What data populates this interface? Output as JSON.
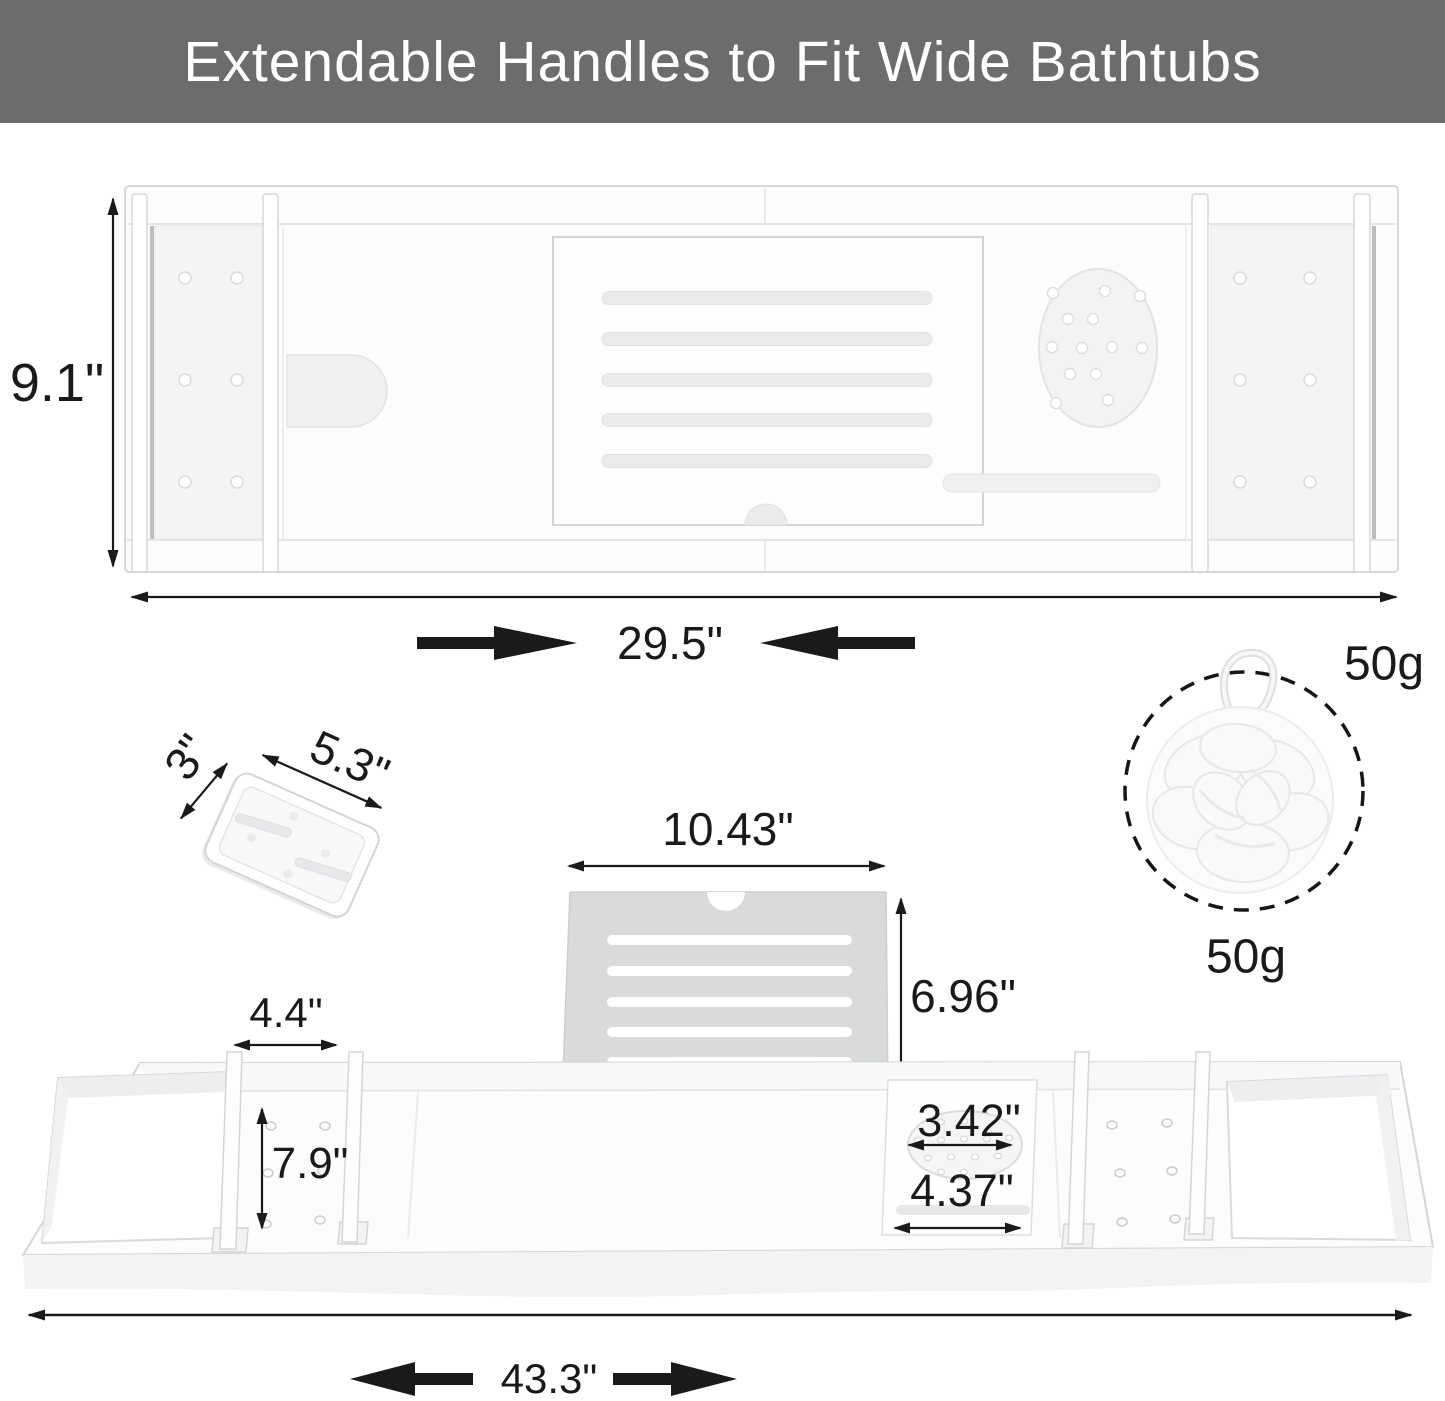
{
  "header": {
    "title": "Extendable Handles to Fit Wide Bathtubs",
    "bg_color": "#6a6c6d",
    "text_color": "#ffffff"
  },
  "colors": {
    "dimension_ink": "#1a1a1a",
    "product_outline": "#d5d7d9",
    "stand_fill": "#d8dadb",
    "background": "#ffffff"
  },
  "top_view": {
    "depth_label": "9.1\"",
    "retracted_width_label": "29.5\""
  },
  "soap_dish": {
    "depth_label": "3\"",
    "width_label": "5.3\""
  },
  "book_stand": {
    "width_label": "10.43\"",
    "height_label": "6.96\""
  },
  "sponge": {
    "weight_label_right": "50g",
    "weight_label_below": "50g"
  },
  "bottom_view": {
    "divider_gap_label": "4.4\"",
    "tray_width_label": "7.9\"",
    "cup_inner_diameter_label": "3.42\"",
    "cup_outer_width_label": "4.37\"",
    "extended_length_label": "43.3\""
  }
}
